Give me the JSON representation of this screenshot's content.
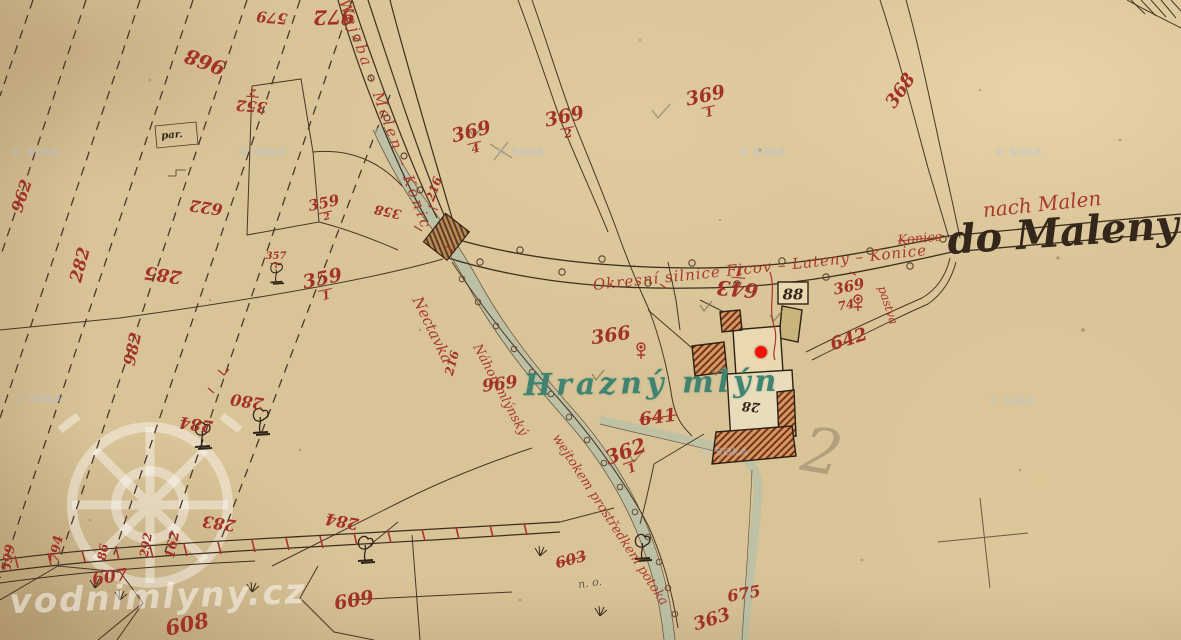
{
  "map": {
    "place_name": "Hrazný mlýn",
    "destination_ink": "do Maleny",
    "destination_red": "nach Malen",
    "road_label_upper": "Wejzba – Malen – Konic",
    "road_label_main": "Okresní silnice  Ficov – Lateny – Konice",
    "stream_labels": [
      "Nectavka",
      "Náhon mlýnský",
      "wejtokem prostředkem potoka"
    ],
    "house_numbers": [
      "88",
      "28"
    ],
    "marker_color": "#ef1309"
  },
  "watermark": {
    "site": "vodnimlyny.cz",
    "tile": "© SOkA"
  },
  "labels": [
    {
      "id": "579",
      "t": "579",
      "x": 272,
      "y": 17,
      "r": 185,
      "s": 15,
      "c": "red"
    },
    {
      "id": "972",
      "t": "972",
      "x": 334,
      "y": 17,
      "r": 178,
      "s": 20,
      "c": "red"
    },
    {
      "id": "968",
      "t": "968",
      "x": 205,
      "y": 62,
      "r": 200,
      "s": 20,
      "c": "red"
    },
    {
      "id": "352-2",
      "t": "352",
      "f": "2",
      "x": 252,
      "y": 100,
      "r": 185,
      "s": 15,
      "c": "red"
    },
    {
      "id": "962",
      "t": "962",
      "x": 22,
      "y": 196,
      "r": -72,
      "s": 16,
      "c": "red"
    },
    {
      "id": "282",
      "t": "282",
      "x": 81,
      "y": 265,
      "r": -75,
      "s": 17,
      "c": "red"
    },
    {
      "id": "285",
      "t": "285",
      "x": 163,
      "y": 274,
      "r": 188,
      "s": 18,
      "c": "red"
    },
    {
      "id": "982",
      "t": "982",
      "x": 133,
      "y": 349,
      "r": -78,
      "s": 16,
      "c": "red"
    },
    {
      "id": "622",
      "t": "622",
      "x": 206,
      "y": 207,
      "r": 188,
      "s": 16,
      "c": "red"
    },
    {
      "id": "359-2",
      "t": "359",
      "f": "2",
      "x": 325,
      "y": 209,
      "r": -12,
      "s": 15,
      "c": "red"
    },
    {
      "id": "357-1",
      "t": "357",
      "f": "1",
      "x": 276,
      "y": 261,
      "r": 0,
      "s": 10,
      "c": "red"
    },
    {
      "id": "359-1",
      "t": "359",
      "f": "1",
      "x": 324,
      "y": 286,
      "r": -12,
      "s": 19,
      "c": "red"
    },
    {
      "id": "358",
      "t": "358",
      "x": 388,
      "y": 211,
      "r": 192,
      "s": 13,
      "c": "red"
    },
    {
      "id": "216a",
      "t": "216",
      "x": 434,
      "y": 189,
      "r": -70,
      "s": 12,
      "c": "red"
    },
    {
      "id": "216b",
      "t": "216",
      "x": 452,
      "y": 363,
      "r": -75,
      "s": 12,
      "c": "red"
    },
    {
      "id": "369-4",
      "t": "369",
      "f": "4",
      "x": 473,
      "y": 139,
      "r": -14,
      "s": 19,
      "c": "red"
    },
    {
      "id": "369-2",
      "t": "369",
      "f": "2",
      "x": 566,
      "y": 124,
      "r": -12,
      "s": 19,
      "c": "red"
    },
    {
      "id": "369-1",
      "t": "369",
      "f": "1",
      "x": 707,
      "y": 103,
      "r": -12,
      "s": 19,
      "c": "red"
    },
    {
      "id": "368",
      "t": "368",
      "x": 901,
      "y": 91,
      "r": -55,
      "s": 18,
      "c": "red"
    },
    {
      "id": "366",
      "t": "366",
      "x": 611,
      "y": 336,
      "r": -8,
      "s": 19,
      "c": "red"
    },
    {
      "id": "362-1",
      "t": "362",
      "f": "1",
      "x": 628,
      "y": 458,
      "r": -20,
      "s": 20,
      "c": "red"
    },
    {
      "id": "641",
      "t": "641",
      "x": 658,
      "y": 418,
      "r": -8,
      "s": 18,
      "c": "red",
      "st": true
    },
    {
      "id": "642",
      "t": "642",
      "x": 849,
      "y": 340,
      "r": -18,
      "s": 18,
      "c": "red"
    },
    {
      "id": "643-1",
      "t": "643",
      "f": "1",
      "x": 738,
      "y": 282,
      "r": 185,
      "s": 20,
      "c": "red"
    },
    {
      "id": "369b",
      "t": "369",
      "x": 849,
      "y": 287,
      "r": -12,
      "s": 15,
      "c": "red"
    },
    {
      "id": "74",
      "t": "74",
      "x": 846,
      "y": 305,
      "r": -10,
      "s": 12,
      "c": "red"
    },
    {
      "id": "88",
      "t": "88",
      "x": 793,
      "y": 295,
      "r": 0,
      "s": 15,
      "c": "ink"
    },
    {
      "id": "28",
      "t": "28",
      "x": 751,
      "y": 406,
      "r": 185,
      "s": 13,
      "c": "ink"
    },
    {
      "id": "969",
      "t": "969",
      "x": 500,
      "y": 385,
      "r": -8,
      "s": 17,
      "c": "red"
    },
    {
      "id": "280",
      "t": "280",
      "x": 247,
      "y": 401,
      "r": 188,
      "s": 16,
      "c": "red"
    },
    {
      "id": "284a",
      "t": "284",
      "x": 196,
      "y": 424,
      "r": 188,
      "s": 16,
      "c": "red"
    },
    {
      "id": "283",
      "t": "283",
      "x": 219,
      "y": 523,
      "r": 188,
      "s": 16,
      "c": "red"
    },
    {
      "id": "284b",
      "t": "284",
      "x": 342,
      "y": 521,
      "r": 190,
      "s": 16,
      "c": "red"
    },
    {
      "id": "162",
      "t": "162",
      "x": 173,
      "y": 545,
      "r": -78,
      "s": 13,
      "c": "red"
    },
    {
      "id": "292",
      "t": "292",
      "x": 146,
      "y": 545,
      "r": -80,
      "s": 12,
      "c": "red"
    },
    {
      "id": "86",
      "t": "86",
      "x": 103,
      "y": 552,
      "r": -80,
      "s": 12,
      "c": "red"
    },
    {
      "id": "794",
      "t": "794",
      "x": 57,
      "y": 549,
      "r": -80,
      "s": 13,
      "c": "red"
    },
    {
      "id": "599",
      "t": "599",
      "x": 9,
      "y": 558,
      "r": -80,
      "s": 13,
      "c": "red"
    },
    {
      "id": "607",
      "t": "607",
      "x": 110,
      "y": 578,
      "r": -8,
      "s": 17,
      "c": "red"
    },
    {
      "id": "608",
      "t": "608",
      "x": 187,
      "y": 624,
      "r": -12,
      "s": 21,
      "c": "red"
    },
    {
      "id": "609",
      "t": "609",
      "x": 354,
      "y": 601,
      "r": -10,
      "s": 19,
      "c": "red"
    },
    {
      "id": "603",
      "t": "603",
      "x": 571,
      "y": 560,
      "r": -15,
      "s": 15,
      "c": "red",
      "st": true
    },
    {
      "id": "675",
      "t": "675",
      "x": 744,
      "y": 594,
      "r": -10,
      "s": 16,
      "c": "red"
    },
    {
      "id": "363",
      "t": "363",
      "x": 712,
      "y": 620,
      "r": -18,
      "s": 18,
      "c": "red"
    },
    {
      "id": "road1",
      "t": "Wejzba – Malen – Konic",
      "x": 385,
      "y": 115,
      "r": 70,
      "s": 15,
      "c": "redcur",
      "ls": 3
    },
    {
      "id": "road2",
      "t": "Okresní silnice  Ficov – Lateny – Konice",
      "x": 760,
      "y": 268,
      "r": -6,
      "s": 15,
      "c": "redcur",
      "ls": 1
    },
    {
      "id": "konice",
      "t": "Konice",
      "x": 920,
      "y": 239,
      "r": -5,
      "s": 13,
      "c": "redcur",
      "st": true
    },
    {
      "id": "nach-malen",
      "t": "nach Malen",
      "x": 1042,
      "y": 204,
      "r": -6,
      "s": 20,
      "c": "redcur"
    },
    {
      "id": "stream1",
      "t": "Nectavka",
      "x": 432,
      "y": 330,
      "r": 64,
      "s": 15,
      "c": "redcur"
    },
    {
      "id": "stream2",
      "t": "Náhon mlýnský",
      "x": 500,
      "y": 390,
      "r": 62,
      "s": 13,
      "c": "redcur"
    },
    {
      "id": "stream3",
      "t": "wejtokem prostředkem potoka",
      "x": 610,
      "y": 520,
      "r": 57,
      "s": 13,
      "c": "redcur"
    },
    {
      "id": "pastva",
      "t": "pastva",
      "x": 888,
      "y": 305,
      "r": 72,
      "s": 12,
      "c": "redcur"
    },
    {
      "id": "do-maleny",
      "t": "do Maleny",
      "x": 1063,
      "y": 233,
      "r": -4,
      "s": 40,
      "c": "inkcur"
    },
    {
      "id": "par",
      "t": "par.",
      "x": 172,
      "y": 136,
      "r": -5,
      "s": 10,
      "c": "ink"
    },
    {
      "id": "no",
      "t": "n. o.",
      "x": 590,
      "y": 583,
      "r": -8,
      "s": 11,
      "c": "pencil2"
    },
    {
      "id": "hrazny-mlyn",
      "t": "Hrazný mlýn",
      "x": 652,
      "y": 384,
      "r": -1,
      "s": 30,
      "c": "green"
    },
    {
      "id": "pencil-2",
      "t": "2",
      "x": 822,
      "y": 452,
      "r": 10,
      "s": 62,
      "c": "pencil"
    },
    {
      "id": "site",
      "t": "vodnimlyny.cz",
      "x": 158,
      "y": 597,
      "r": -2,
      "s": 34,
      "c": "wmtext"
    },
    {
      "id": "wm1",
      "t": "© SOkA",
      "x": 35,
      "y": 152,
      "r": 0,
      "s": 11,
      "c": "wmtile"
    },
    {
      "id": "wm2",
      "t": "© SOkA",
      "x": 262,
      "y": 152,
      "r": 0,
      "s": 11,
      "c": "wmtile"
    },
    {
      "id": "wm3",
      "t": "© SOkA",
      "x": 520,
      "y": 152,
      "r": 0,
      "s": 11,
      "c": "wmtile"
    },
    {
      "id": "wm4",
      "t": "© SOkA",
      "x": 762,
      "y": 152,
      "r": 0,
      "s": 11,
      "c": "wmtile"
    },
    {
      "id": "wm5",
      "t": "© SOkA",
      "x": 1018,
      "y": 152,
      "r": 0,
      "s": 11,
      "c": "wmtile"
    },
    {
      "id": "wm6",
      "t": "© SOkA",
      "x": 38,
      "y": 399,
      "r": 0,
      "s": 11,
      "c": "wmtile"
    },
    {
      "id": "wm7",
      "t": "© SOkA",
      "x": 1012,
      "y": 401,
      "r": 0,
      "s": 11,
      "c": "wmtile"
    },
    {
      "id": "wm8",
      "t": "© SOkA",
      "x": 724,
      "y": 452,
      "r": 0,
      "s": 11,
      "c": "wmtile"
    }
  ],
  "marker": {
    "x": 761,
    "y": 352
  }
}
